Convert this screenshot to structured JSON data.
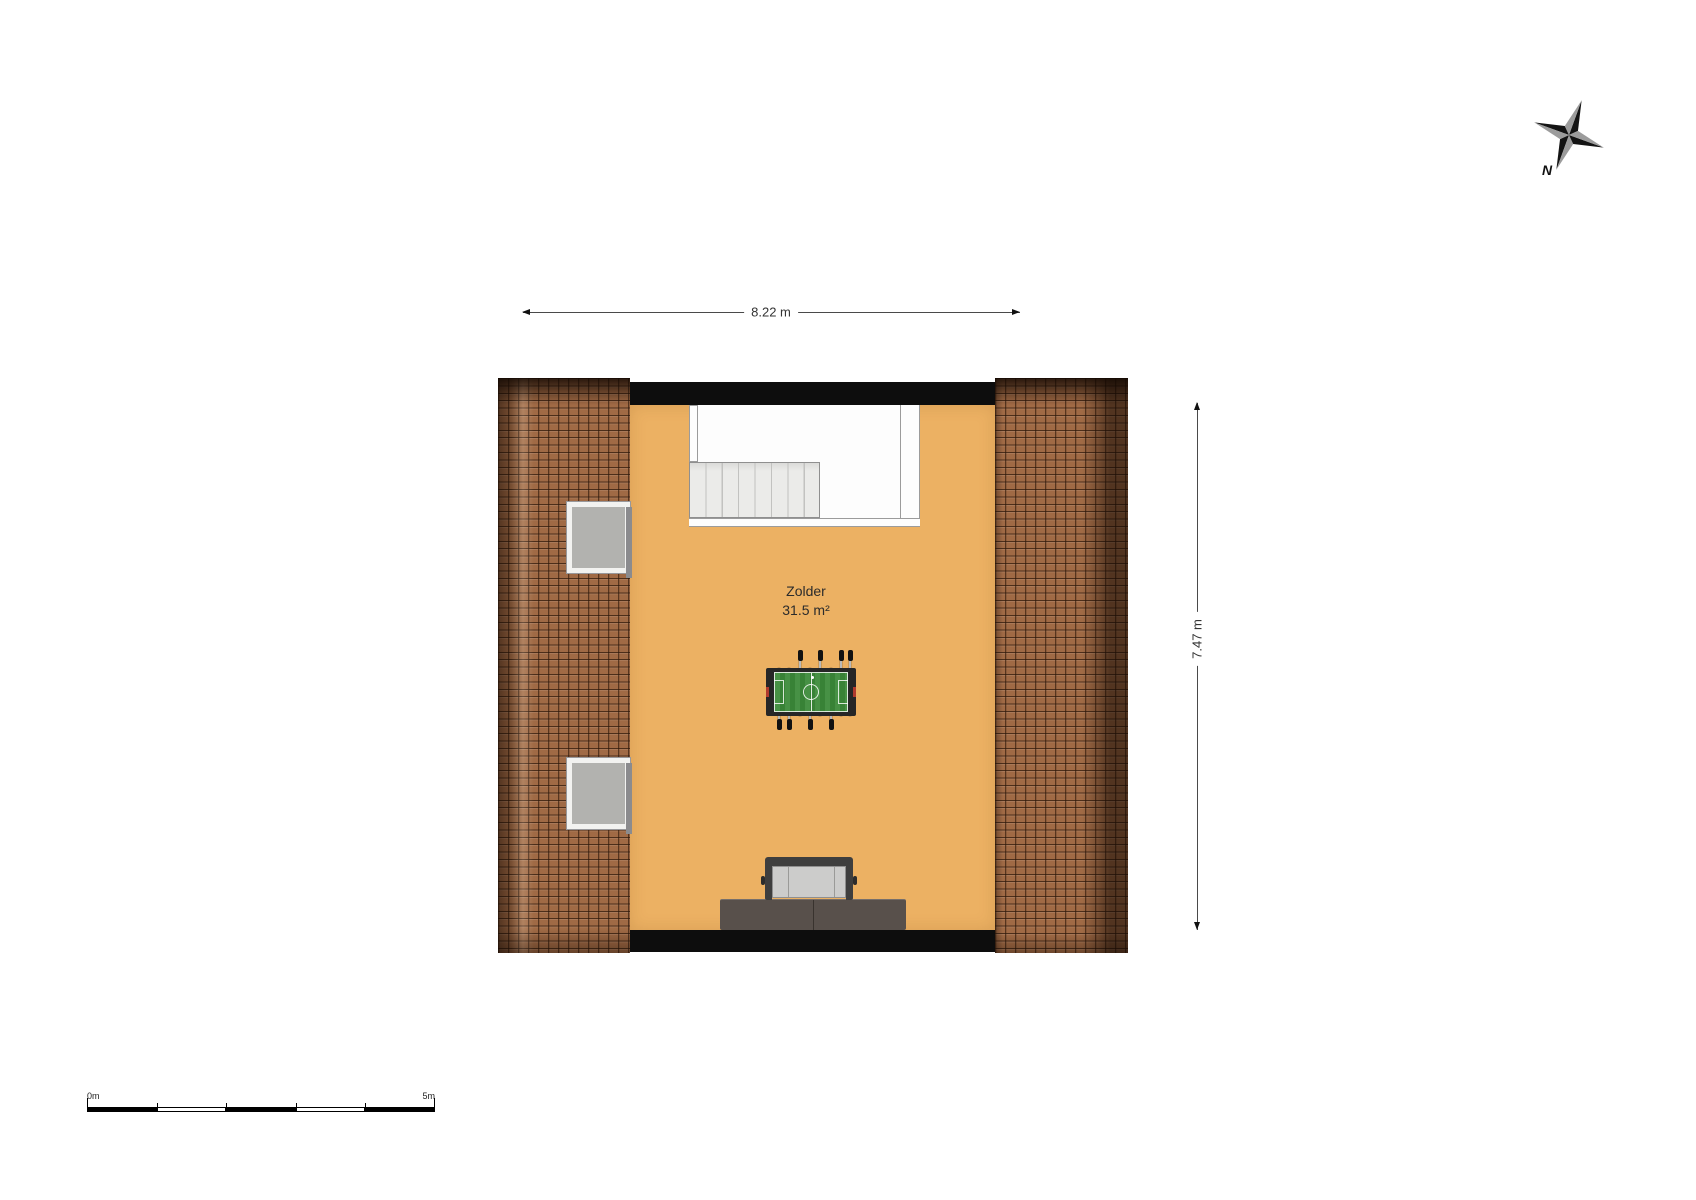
{
  "room": {
    "name": "Zolder",
    "area": "31.5 m²"
  },
  "dimensions": {
    "width": "8.22 m",
    "height": "7.47 m"
  },
  "compass": {
    "north": "N"
  },
  "scale_bar": {
    "start": "0m",
    "end": "5m"
  },
  "colors": {
    "floor": "#ecb163",
    "roof_tile": "#a06a45",
    "wall": "#0d0d0d",
    "stair_white": "#fdfdfd",
    "stair_tread": "#ebebe9",
    "glass": "#b2b2af",
    "field_green": "#3c8a39",
    "goal_red": "#b03a2e",
    "couch_cushion": "#cccccb",
    "cabinet": "#58504b",
    "dim_line": "#4a4a4a",
    "text": "#2b2b2b"
  }
}
